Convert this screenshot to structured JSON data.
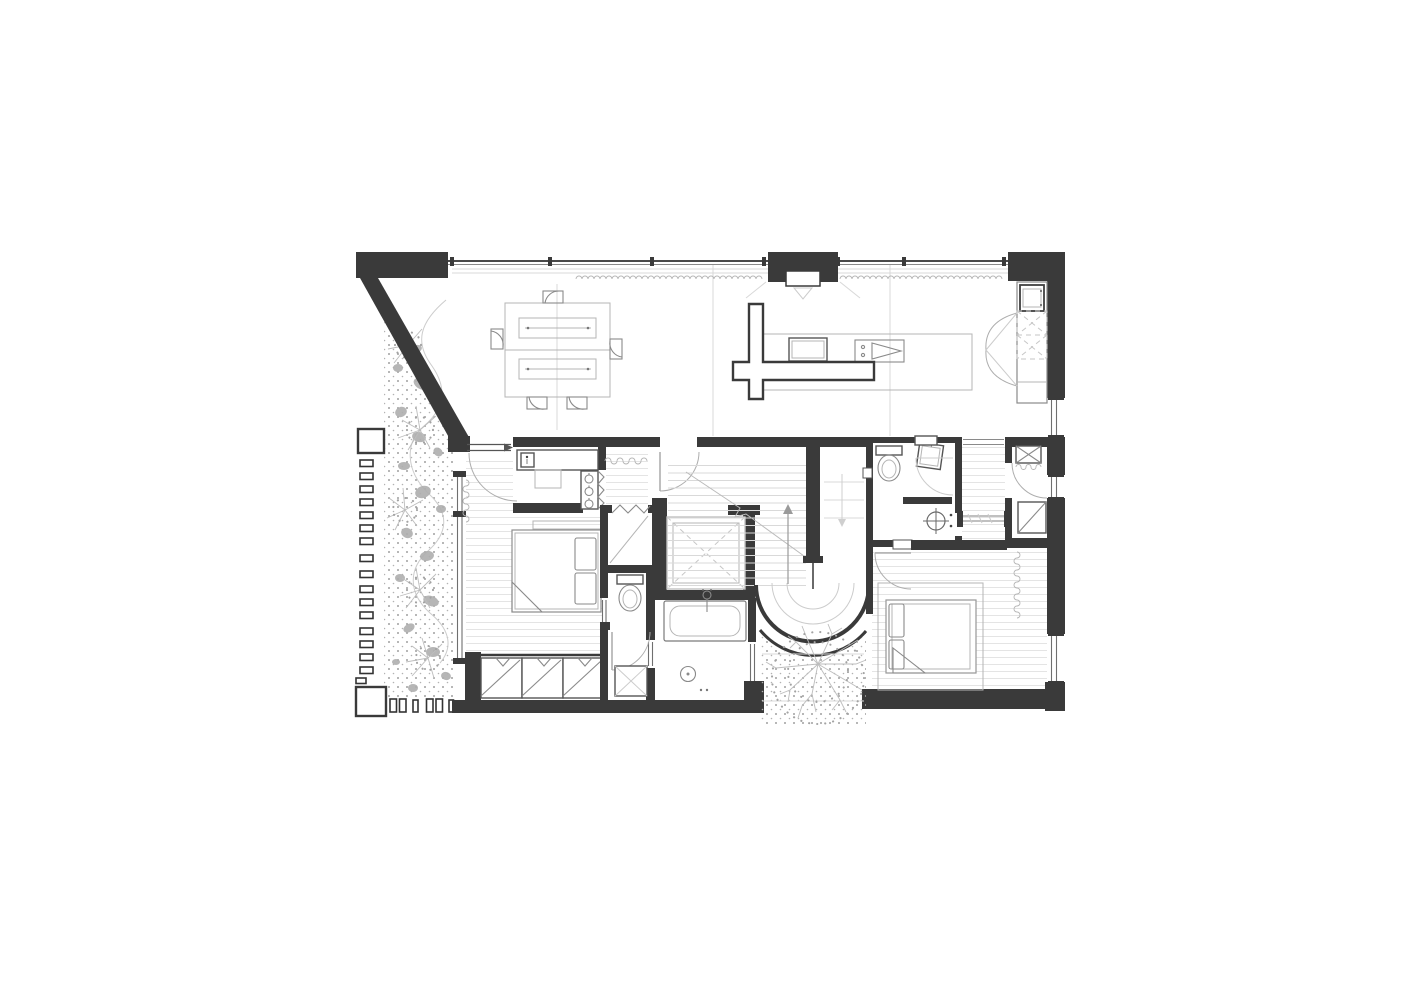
{
  "canvas": {
    "width": 1416,
    "height": 1000,
    "background": "#ffffff"
  },
  "colors": {
    "bg": "#ffffff",
    "wall": "#3a3a3a",
    "line-strong": "#555555",
    "line-mid": "#8a8a8a",
    "line-soft": "#b5b5b5",
    "line-faint": "#d8d8d8",
    "floor-line": "#e4e4e4",
    "tread-line": "#d9d9d9",
    "dot": "#a3a3a3",
    "blob": "#aeaeae",
    "branch": "#bdbdbd"
  },
  "drawing": {
    "type": "architectural-floor-plan",
    "visible_text": [],
    "symbols": [
      {
        "name": "dining-table",
        "count": 1,
        "chairs": 5
      },
      {
        "name": "kitchen-island-with-sink-and-cooktop",
        "count": 1
      },
      {
        "name": "cross-shaped-partition",
        "count": 1
      },
      {
        "name": "tall-cabinet-with-appliance-and-double-doors",
        "count": 1
      },
      {
        "name": "entry-sliding-door",
        "count": 1
      },
      {
        "name": "double-bed",
        "count": 2
      },
      {
        "name": "vanity-counter-with-sink",
        "count": 1
      },
      {
        "name": "wardrobe-with-hangers",
        "hangers": 3
      },
      {
        "name": "sliding-door-closet",
        "panels": 3
      },
      {
        "name": "toilet",
        "count": 2
      },
      {
        "name": "washbasin",
        "count": 1
      },
      {
        "name": "bathtub",
        "count": 1
      },
      {
        "name": "shower",
        "count": 2
      },
      {
        "name": "washing-machine",
        "count": 1
      },
      {
        "name": "skylight-void-dashed-x",
        "count": 1
      },
      {
        "name": "duct-shaft",
        "count": 1
      },
      {
        "name": "stair-with-up-arrow",
        "count": 1
      },
      {
        "name": "curved-stair-wall",
        "count": 1
      },
      {
        "name": "courtyard-tree",
        "count": 1
      },
      {
        "name": "planting-bed-with-shrubs",
        "count": 1
      },
      {
        "name": "slat-fence",
        "slats": 17
      },
      {
        "name": "curtain-squiggle",
        "count": 4
      },
      {
        "name": "scalloped-curtain-line",
        "count": 2
      }
    ]
  }
}
